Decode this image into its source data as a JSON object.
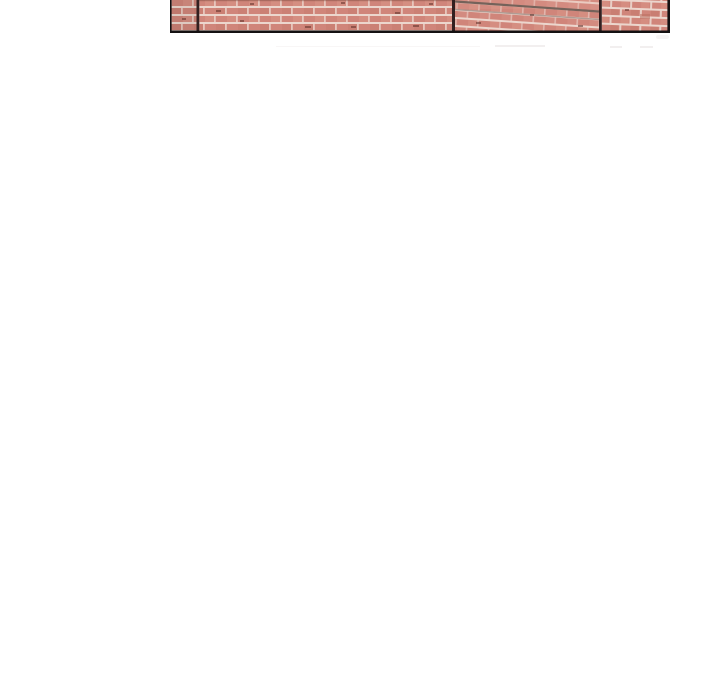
{
  "page": {
    "description": "Blank white page; only the bottom sliver of a framed photo of a red brick wall is visible at the very top, cut off by the viewport edge."
  },
  "image": {
    "label": "brick-wall-photo-fragment",
    "description": "Bottom edge of a photograph of a salmon-red brick wall in a thin black frame. Three dark vertical seams split the wall into four panels; brick courses in the third panel slope down to the right; faint compression ghost marks appear just below the frame.",
    "panel_count": 4
  },
  "colors": {
    "pageBg": "#ffffff",
    "brick": "#d0857a",
    "brickLight": "#e2a494",
    "brickDark": "#b96f61",
    "mortar": "#ecd6cd",
    "speck": "#5f2f28",
    "divider": "#332020",
    "frame": "#141112",
    "slantShadow": "#75625a",
    "ghost": "#f2efef"
  }
}
